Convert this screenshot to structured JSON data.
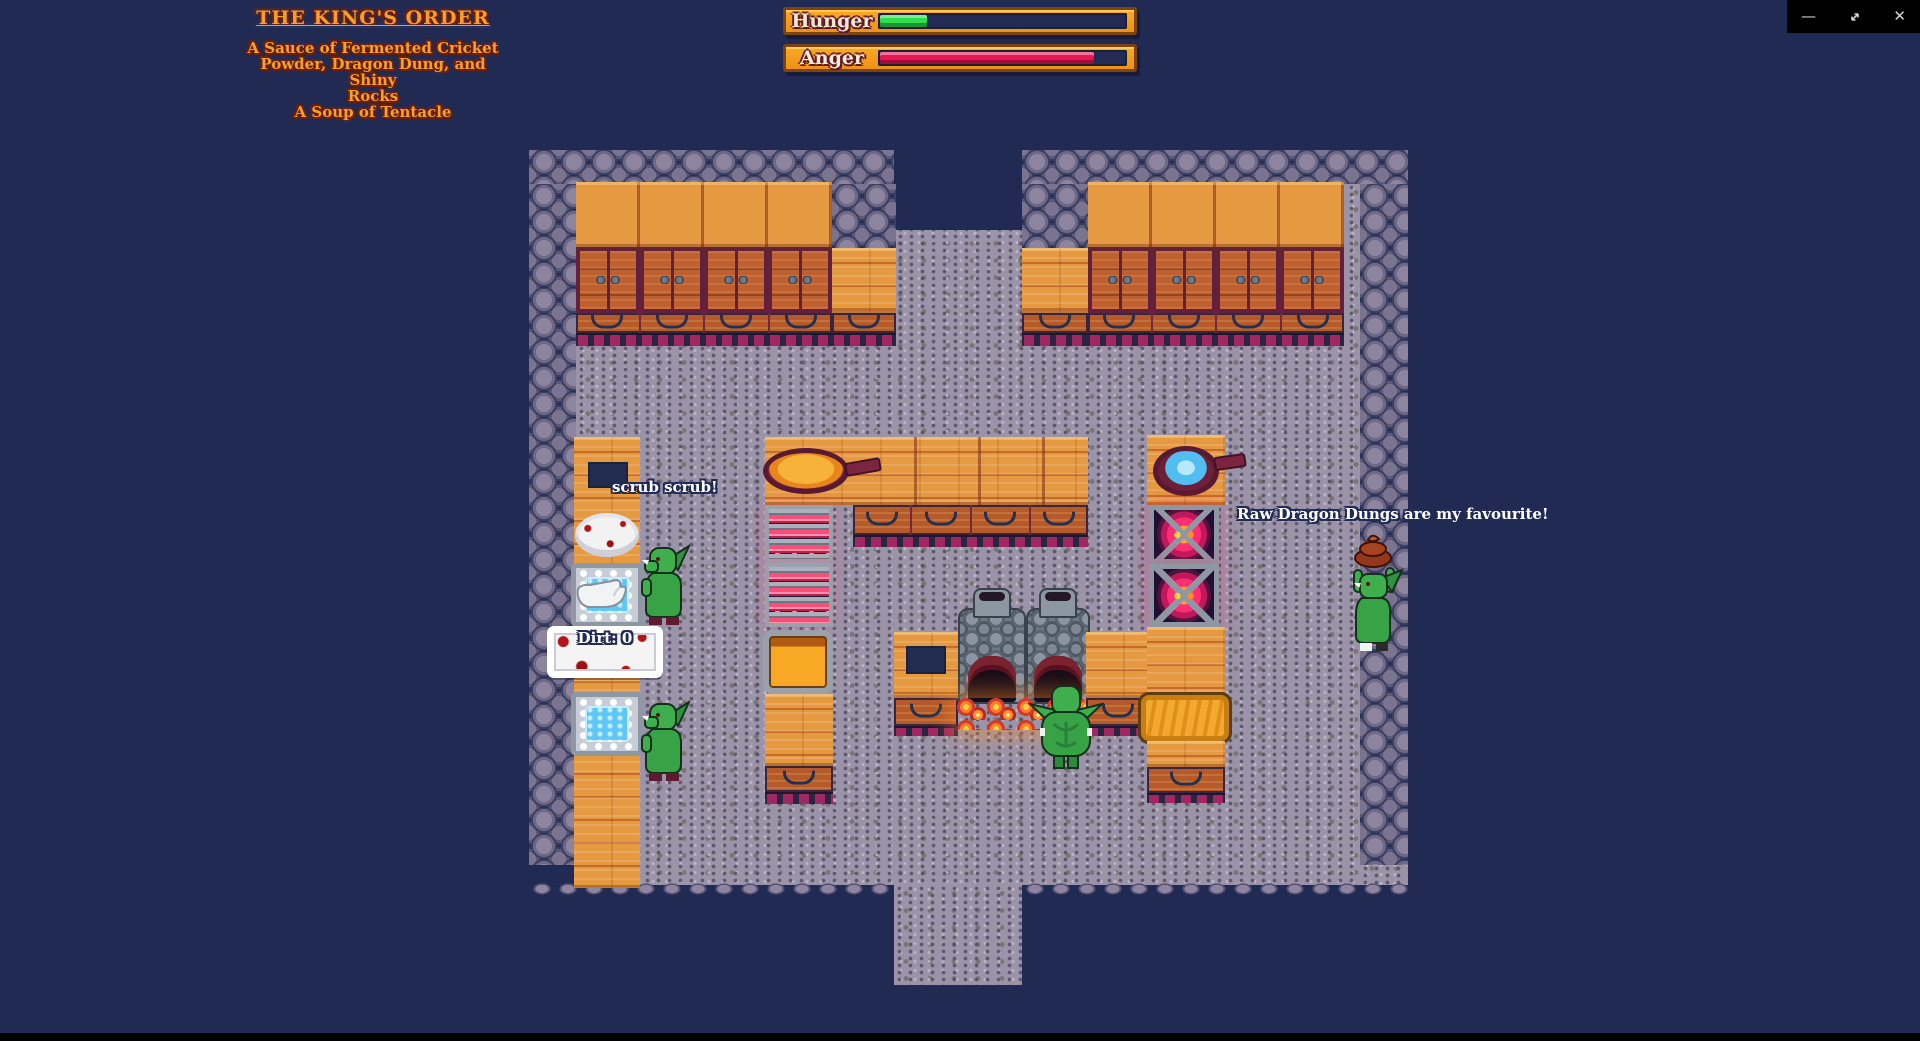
{
  "window_controls": {
    "minimize_icon": "—",
    "restore_icon": "diagonal-resize-arrows",
    "close_icon": "✕"
  },
  "hud": {
    "kings_order": {
      "title": "THE KING'S ORDER",
      "lines": [
        "A Sauce of Fermented Cricket",
        "Powder, Dragon Dung, and Shiny",
        "Rocks",
        "A Soup of Tentacle"
      ]
    },
    "bars": {
      "hunger": {
        "label": "Hunger",
        "fill_width": "19%",
        "fill_color": "#2ede4e"
      },
      "anger": {
        "label": "Anger",
        "fill_width": "86%",
        "fill_color": "#ed1455"
      }
    }
  },
  "speech_bubbles": {
    "dishwasher": "scrub scrub!",
    "dung_lover": "Raw Dragon Dungs are my favourite!"
  },
  "labels": {
    "dirt_counter": "Dirt: 0"
  },
  "palette": {
    "background": "#212a52",
    "floor": "#9b94a8",
    "wall_stone": "#7b7490",
    "wood_light": "#e59a42",
    "wood_dark": "#bf6030",
    "cabinet_frame": "#63203a",
    "base_slat": "#a12762",
    "goblin_green": "#3fae4c",
    "bar_frame": "#f39c1f",
    "title_gold": "#f2a031",
    "fire_pink": "#ff2e72",
    "ember_orange": "#ff8c2e",
    "water_blue": "#5ec7f5",
    "blood_red": "#b01818",
    "dung_brown": "#a6441f"
  }
}
